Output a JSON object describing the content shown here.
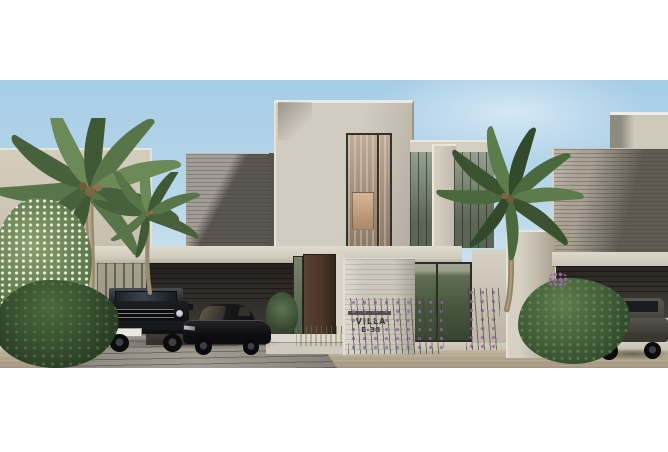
{
  "sign": {
    "line1": "VILLA",
    "line2": "E-38"
  },
  "palette": {
    "frame_white": "#ffffff",
    "sky_top": "#a6cde7",
    "sky_horizon": "#e7eef2",
    "wall_beige": "#cdc6ba",
    "stone_gray": "#96908a",
    "fascia_light": "#d0cabc",
    "carport_shadow": "#332f2a",
    "door_wood": "#4a3426",
    "glass_green": "#79856f",
    "foliage_dark": "#3c5a33",
    "foliage_light": "#6d8a58",
    "trunk_brown": "#9a8a6f",
    "sidewalk_light": "#d8d3c6",
    "road_tan": "#b3a58e",
    "driveway_gray": "#9d978d",
    "car_black": "#101013",
    "suv_graphite": "#39362f",
    "plate_white": "#e9e7df",
    "flower_purple": "#9a63a8",
    "flower_white": "#f2f4ec",
    "sign_text": "#3b3934"
  }
}
